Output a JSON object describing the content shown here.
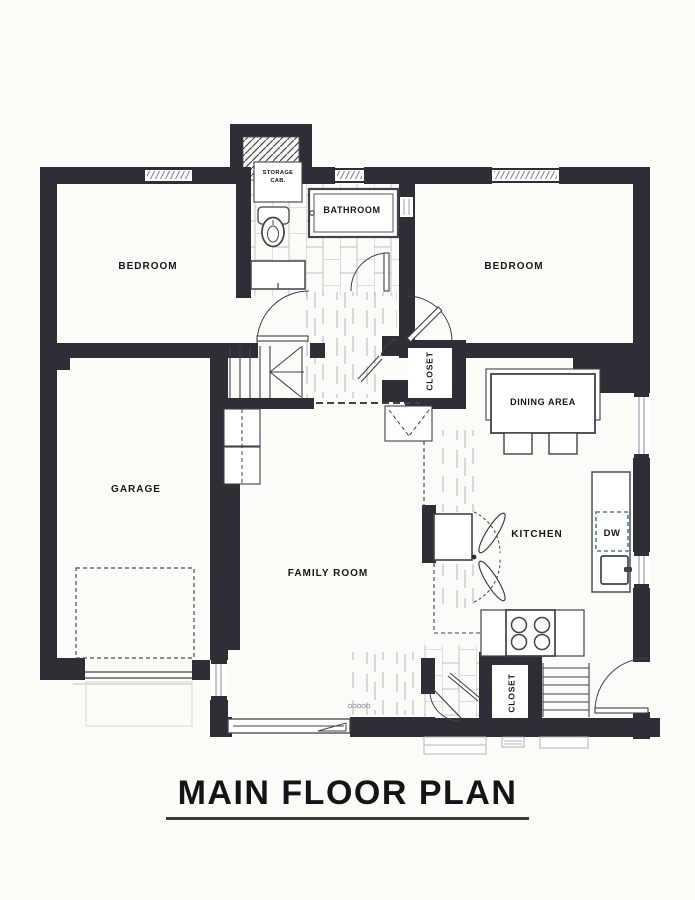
{
  "plan": {
    "title": "MAIN FLOOR PLAN",
    "labels": {
      "bedroom_left": "BEDROOM",
      "bedroom_right": "BEDROOM",
      "bathroom": "BATHROOM",
      "storage_cab_line1": "STORAGE",
      "storage_cab_line2": "CAB.",
      "garage": "GARAGE",
      "family_room": "FAMILY ROOM",
      "dining_area": "DINING AREA",
      "kitchen": "KITCHEN",
      "closet_hall": "CLOSET",
      "closet_rear": "CLOSET",
      "dishwasher": "DW"
    },
    "colors": {
      "wall": "#2e2e37",
      "paper": "#fcfbf8",
      "ink": "#17171c",
      "fixture_line": "#41424b",
      "floor_line": "#aab0ba",
      "dishwasher_accent": "#4f7ea3"
    }
  }
}
